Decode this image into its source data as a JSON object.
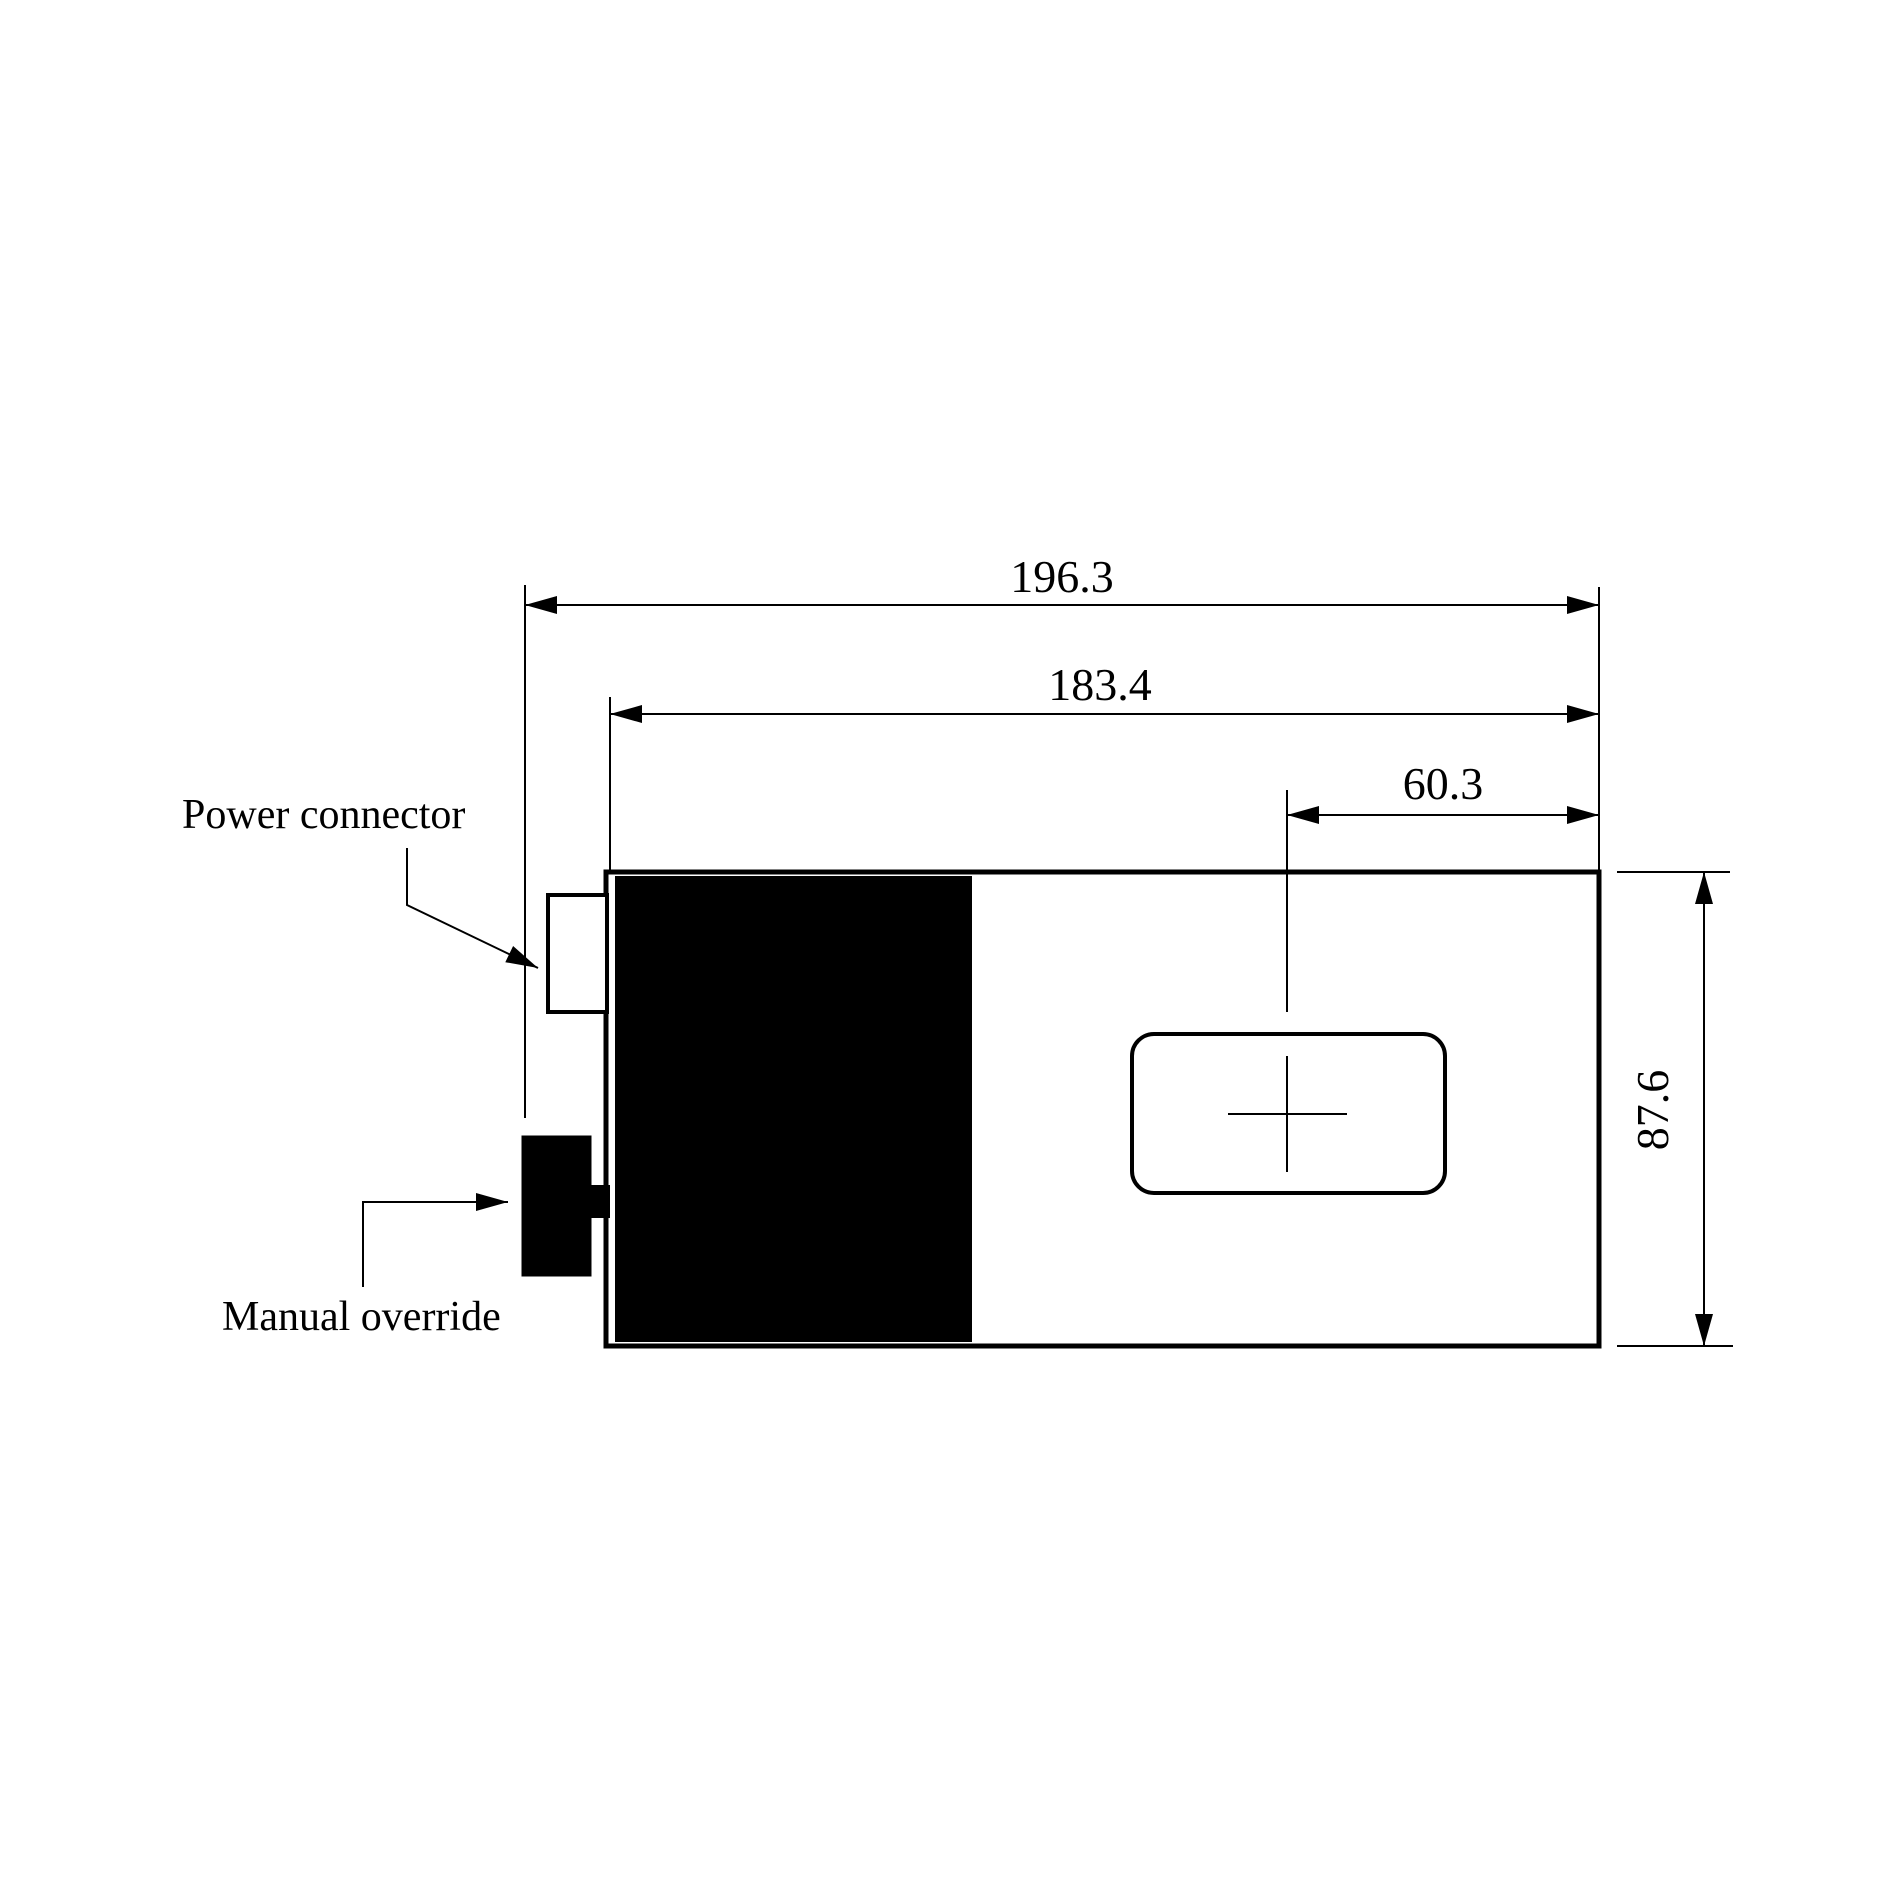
{
  "drawing": {
    "type": "technical-dimension-drawing",
    "background_color": "#ffffff",
    "line_color": "#000000",
    "dimensions": {
      "overall_length": "196.3",
      "body_length": "183.4",
      "window_offset": "60.3",
      "body_height": "87.6"
    },
    "callouts": {
      "power_connector": "Power connector",
      "manual_override": "Manual override"
    }
  }
}
